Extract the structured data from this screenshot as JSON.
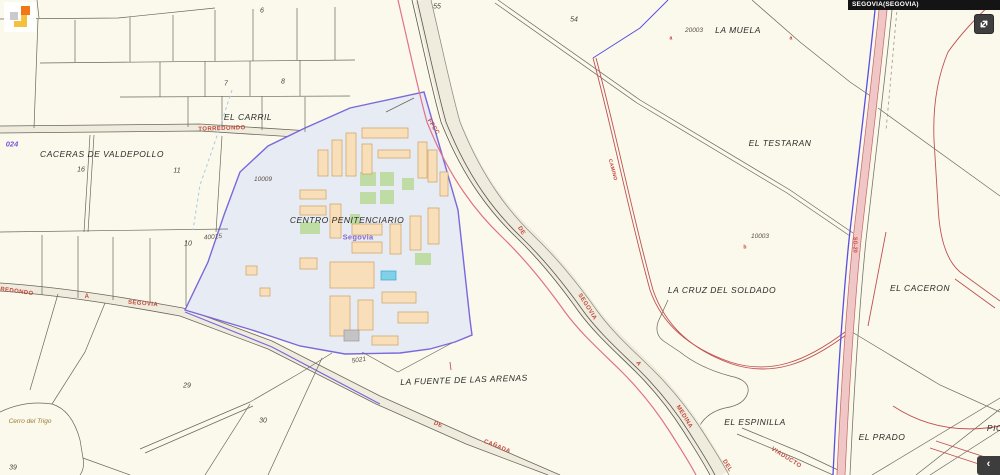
{
  "header": {
    "municipality": "SEGOVIA(SEGOVIA)"
  },
  "controls": {
    "collapse_chevron": "‹"
  },
  "labels": {
    "centro_penitenciario": "CENTRO PENITENCIARIO",
    "segovia_sub": "Segovia",
    "la_muela": "LA MUELA",
    "el_testaran": "EL TESTARAN",
    "la_cruz_del_soldado": "LA CRUZ DEL SOLDADO",
    "el_caceron": "EL CACERON",
    "la_fuente_de_las_arenas": "LA FUENTE DE LAS ARENAS",
    "el_espinilla": "EL ESPINILLA",
    "el_prado": "EL PRADO",
    "el_carril": "EL CARRIL",
    "caceras_de_valdepollo": "CACERAS DE VALDEPOLLO",
    "cerro_del_trigo": "Cerro del Trigo",
    "pio_partial": "PIO"
  },
  "roads": {
    "torredondo": "TORREDONDO",
    "a": "A",
    "segovia": "SEGOVIA",
    "ffcc": "FFCC",
    "de": "DE",
    "rail_segovia": "SEGOVIA",
    "rail_a": "A",
    "medina": "MEDINA",
    "del": "DEL",
    "viaducto": "VIADUCTO",
    "camino": "CAMINO",
    "canada_de": "DE",
    "canada": "CAÑADA",
    "route_024": "024",
    "sg20": "SG-20"
  },
  "numbers": {
    "n6": "6",
    "n7": "7",
    "n8": "8",
    "n55": "55",
    "n54": "54",
    "n16": "16",
    "n11": "11",
    "n10": "10",
    "n10009": "10009",
    "n40015": "40015",
    "n20003": "20003",
    "n10003": "10003",
    "n5021": "5021",
    "n29": "29",
    "n30": "30",
    "n39": "39"
  },
  "markers": {
    "a1": "a",
    "a2": "a",
    "b": "b"
  },
  "colors": {
    "background": "#FAF9EC",
    "selected_parcel_fill": "#E7EBF3",
    "selected_parcel_border": "#7A68DC",
    "building_fill": "#F8DFBA",
    "courtyard_green": "#BFDCA4",
    "pool_blue": "#7FD0E8",
    "railway_magenta": "#E2708C",
    "road_pink": "#F0C6C6",
    "red_line": "#C05050",
    "parcel_line": "#6B675C"
  }
}
